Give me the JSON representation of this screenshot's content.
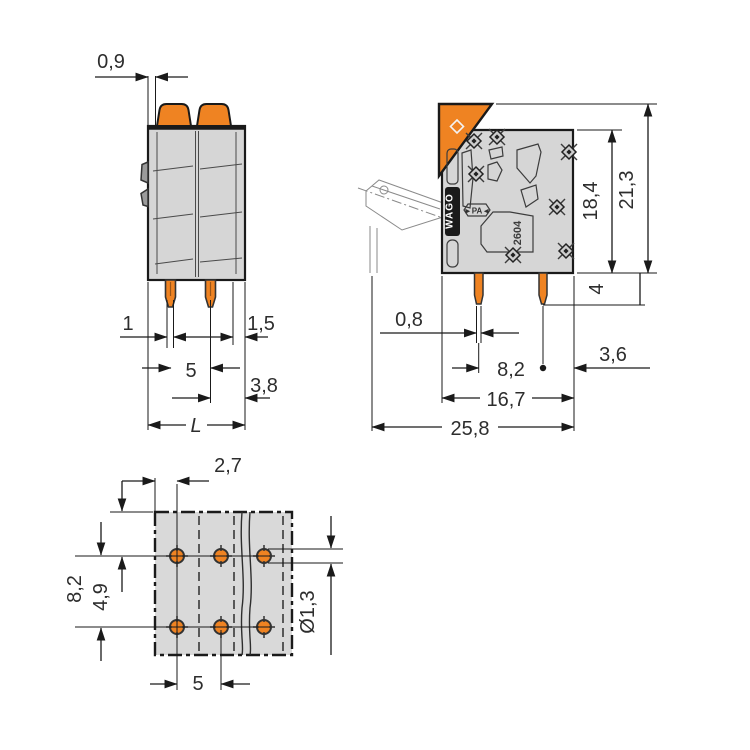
{
  "drawing": {
    "front_view": {
      "dim_wall_top": "0,9",
      "dim_pin_width": "1",
      "dim_right_wall": "1,5",
      "dim_pitch": "5",
      "dim_pin_to_edge": "3,8",
      "dim_length": "L"
    },
    "side_view": {
      "dim_pin_thickness": "0,8",
      "dim_pin_row_spacing": "8,2",
      "dim_pin_to_edge": "3,6",
      "dim_depth": "16,7",
      "dim_overall_depth": "25,8",
      "dim_housing_height": "18,4",
      "dim_overall_height": "21,3",
      "dim_pin_length": "4",
      "marking_brand": "WAGO",
      "marking_material_badge": "►PA◄",
      "marking_series": "2604"
    },
    "footprint_view": {
      "dim_edge_to_first_pin": "2,7",
      "dim_row_spacing": "8,2",
      "dim_edge_to_row": "4,9",
      "dim_pitch": "5",
      "dim_hole_diameter": "Ø1,3"
    }
  },
  "colors": {
    "orange": "#ef8322",
    "housing_gray": "#d6d6d6",
    "footprint_gray": "#d9d9d9",
    "line": "#1a1a1a",
    "dim_text": "#2d2d2d"
  }
}
